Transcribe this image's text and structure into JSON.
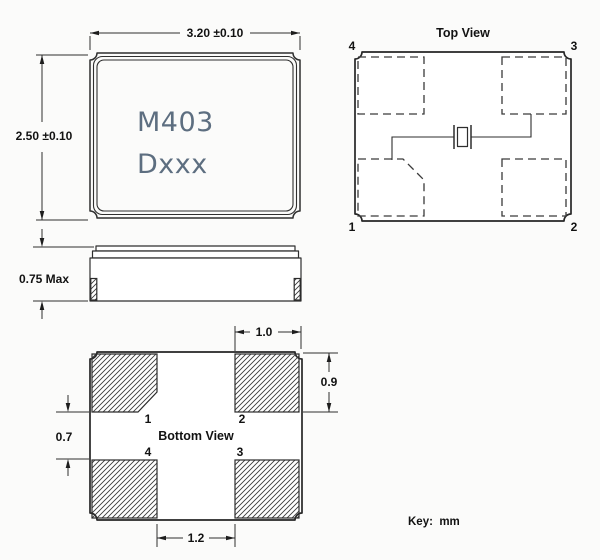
{
  "meta": {
    "key_note": "Key:  mm"
  },
  "colors": {
    "line": "#2e2e2e",
    "marking_text": "#5d6e80",
    "background": "#fbfbfa"
  },
  "front_view": {
    "marking_line1": "M403",
    "marking_line2": "Dxxx",
    "width_dim": "3.20 ±0.10",
    "height_dim": "2.50 ±0.10"
  },
  "side_view": {
    "height_dim": "0.75 Max"
  },
  "top_view": {
    "title": "Top View",
    "pin_top_left": "4",
    "pin_top_right": "3",
    "pin_bottom_left": "1",
    "pin_bottom_right": "2"
  },
  "bottom_view": {
    "title": "Bottom View",
    "pad_top_left": "1",
    "pad_top_right": "2",
    "pad_bottom_left": "4",
    "pad_bottom_right": "3",
    "dim_pad_width": "1.0",
    "dim_pad_height": "0.9",
    "dim_pad_gap_vertical": "0.7",
    "dim_pad_gap_horizontal": "1.2"
  }
}
